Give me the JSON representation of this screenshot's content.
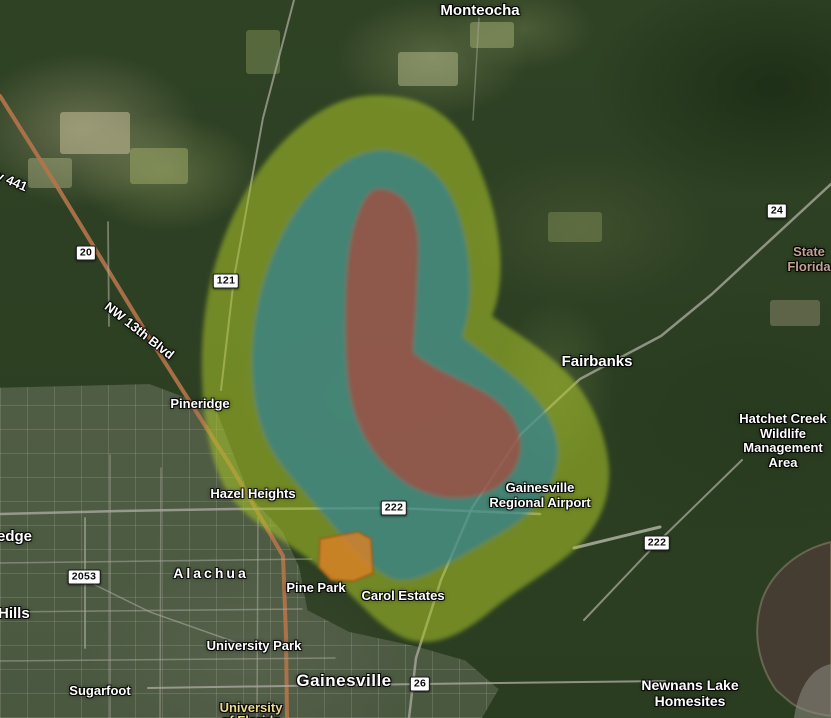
{
  "map": {
    "labels": [
      {
        "id": "monteocha",
        "text": "Monteocha",
        "x": 480,
        "y": 3,
        "size": 15
      },
      {
        "id": "highway-441",
        "text": "Highway 441",
        "x": -46,
        "y": 150,
        "size": 13,
        "rotate": 23,
        "align": "left"
      },
      {
        "id": "nw-13th-blvd",
        "text": "NW 13th Blvd",
        "x": 106,
        "y": 298,
        "size": 13,
        "rotate": 38,
        "align": "left"
      },
      {
        "id": "fairbanks",
        "text": "Fairbanks",
        "x": 597,
        "y": 354,
        "size": 15
      },
      {
        "id": "state-florida",
        "lines": [
          "State",
          "Florida"
        ],
        "x": 809,
        "y": 245,
        "size": 13,
        "color": "#c2a294"
      },
      {
        "id": "hatchet-creek-wma",
        "lines": [
          "Hatchet Creek",
          "Wildlife",
          "Management",
          "Area"
        ],
        "x": 783,
        "y": 412,
        "size": 13
      },
      {
        "id": "pineridge",
        "text": "Pineridge",
        "x": 200,
        "y": 397,
        "size": 13
      },
      {
        "id": "hazel-heights",
        "text": "Hazel Heights",
        "x": 253,
        "y": 487,
        "size": 13
      },
      {
        "id": "gainesville-regional-airport",
        "lines": [
          "Gainesville",
          "Regional Airport"
        ],
        "x": 540,
        "y": 481,
        "size": 13
      },
      {
        "id": "edge",
        "text": "edge",
        "x": -3,
        "y": 529,
        "size": 15,
        "align": "left"
      },
      {
        "id": "alachua",
        "text": "Alachua",
        "x": 211,
        "y": 566,
        "size": 14,
        "ls": 3
      },
      {
        "id": "hills",
        "text": "Hills",
        "x": -2,
        "y": 606,
        "size": 15,
        "align": "left"
      },
      {
        "id": "pine-park",
        "text": "Pine Park",
        "x": 316,
        "y": 581,
        "size": 13
      },
      {
        "id": "carol-estates",
        "text": "Carol Estates",
        "x": 403,
        "y": 589,
        "size": 13
      },
      {
        "id": "university-park",
        "text": "University Park",
        "x": 254,
        "y": 639,
        "size": 13
      },
      {
        "id": "sugarfoot",
        "text": "Sugarfoot",
        "x": 100,
        "y": 684,
        "size": 13
      },
      {
        "id": "gainesville",
        "text": "Gainesville",
        "x": 344,
        "y": 671,
        "size": 17,
        "ls": 0.5
      },
      {
        "id": "newnans-lake-homesites",
        "lines": [
          "Newnans Lake",
          "Homesites"
        ],
        "x": 690,
        "y": 678,
        "size": 14
      },
      {
        "id": "university-poi",
        "text": "University",
        "x": 251,
        "y": 701,
        "size": 13,
        "color": "#f0d98c"
      },
      {
        "id": "university-poi-line2",
        "text": "of Florida",
        "x": 251,
        "y": 714,
        "size": 13,
        "color": "#f0d98c"
      }
    ],
    "shields": [
      {
        "text": "20",
        "x": 86,
        "y": 253
      },
      {
        "text": "121",
        "x": 226,
        "y": 281
      },
      {
        "text": "24",
        "x": 777,
        "y": 211
      },
      {
        "text": "222",
        "x": 394,
        "y": 508
      },
      {
        "text": "222",
        "x": 657,
        "y": 543
      },
      {
        "text": "2053",
        "x": 84,
        "y": 577
      },
      {
        "text": "26",
        "x": 420,
        "y": 684
      }
    ],
    "overlays": {
      "outer": {
        "name": "outer-zone",
        "color": "#a9c42a",
        "opacity": 0.55
      },
      "middle": {
        "name": "middle-zone",
        "color": "#2381ad",
        "opacity": 0.58
      },
      "inner": {
        "name": "inner-zone",
        "color": "#c23b30",
        "opacity": 0.6
      },
      "spot": {
        "name": "spot-zone",
        "color": "#dd7f26",
        "opacity": 0.8,
        "stroke": "#a05a12"
      }
    },
    "water": {
      "lake_color": "#453d31",
      "shore_color": "#8d8d81"
    },
    "roads": [
      {
        "name": "us-441",
        "color": "#b5744a",
        "w": 4,
        "o": 0.9,
        "pts": "0,96 58,188 152,342 232,468 283,556 286,636 287,718"
      },
      {
        "name": "sr-121",
        "color": "#a8a89c",
        "w": 2,
        "o": 0.75,
        "pts": "294,0 263,118 234,278 221,390"
      },
      {
        "name": "cr-225",
        "color": "#a8a89c",
        "w": 1.5,
        "o": 0.5,
        "pts": "479,18 473,120"
      },
      {
        "name": "sr-24-waldo",
        "color": "#a8a89c",
        "w": 2.5,
        "o": 0.8,
        "pts": "831,184 712,294 661,336 580,379 521,434 472,508 441,580 416,658 409,718"
      },
      {
        "name": "sr-222",
        "color": "#a8a89c",
        "w": 2.5,
        "o": 0.8,
        "pts": "0,514 120,511 232,509 395,508 540,514"
      },
      {
        "name": "sr-222-east",
        "color": "#a8a89c",
        "w": 2,
        "o": 0.75,
        "pts": "742,460 657,543 584,620"
      },
      {
        "name": "sr-26-university-ave",
        "color": "#a8a89c",
        "w": 2,
        "o": 0.8,
        "pts": "148,688 420,684 665,681"
      },
      {
        "name": "sr-20",
        "color": "#a8a89c",
        "w": 1.8,
        "o": 0.6,
        "pts": "108,222 109,326"
      },
      {
        "name": "cr-2053",
        "color": "#a8a89c",
        "w": 1.8,
        "o": 0.7,
        "pts": "85,518 85,648"
      },
      {
        "name": "cr-2053-diag",
        "color": "#a8a89c",
        "w": 1.5,
        "o": 0.6,
        "pts": "85,580 150,612 235,642"
      },
      {
        "name": "street-h2",
        "color": "#a8a89c",
        "w": 1.5,
        "o": 0.55,
        "pts": "0,563 312,559"
      },
      {
        "name": "street-h3",
        "color": "#a8a89c",
        "w": 1.5,
        "o": 0.55,
        "pts": "0,612 302,609"
      },
      {
        "name": "street-h4",
        "color": "#a8a89c",
        "w": 1.5,
        "o": 0.55,
        "pts": "0,661 335,658"
      },
      {
        "name": "street-v1",
        "color": "#a8a89c",
        "w": 1.5,
        "o": 0.5,
        "pts": "110,455 110,718"
      },
      {
        "name": "street-v2",
        "color": "#a8a89c",
        "w": 1.5,
        "o": 0.5,
        "pts": "161,468 160,718"
      },
      {
        "name": "street-v3",
        "color": "#a8a89c",
        "w": 1.5,
        "o": 0.55,
        "pts": "258,518 257,718"
      },
      {
        "name": "airport-runway",
        "color": "#b8b8aa",
        "w": 3,
        "o": 0.8,
        "pts": "574,548 660,527"
      }
    ]
  }
}
